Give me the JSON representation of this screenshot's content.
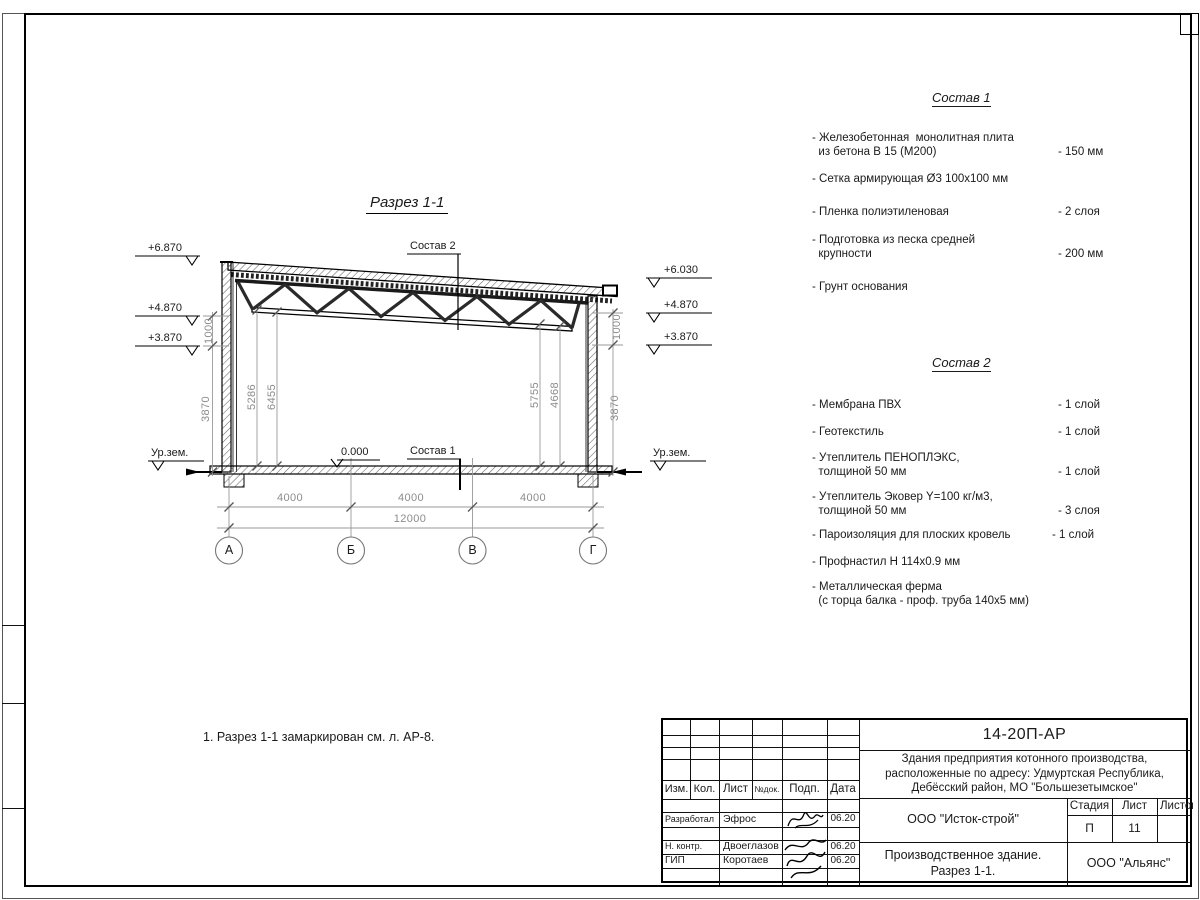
{
  "section": {
    "title": "Разрез 1-1",
    "callout_top": "Состав 2",
    "callout_floor": "Состав 1",
    "level_zero": "0.000",
    "ground_left": "Ур.зем.",
    "ground_right": "Ур.зем.",
    "elev_left": [
      "+6.870",
      "+4.870",
      "+3.870"
    ],
    "elev_right": [
      "+6.030",
      "+4.870",
      "+3.870"
    ],
    "dims": {
      "left_outer": [
        "1000",
        "3870"
      ],
      "left_inner": [
        "5286",
        "6455"
      ],
      "right_inner": [
        "5755",
        "4668"
      ],
      "right_outer": [
        "1000",
        "3870"
      ],
      "spans": [
        "4000",
        "4000",
        "4000"
      ],
      "total": "12000"
    },
    "axes": [
      "А",
      "Б",
      "В",
      "Г"
    ]
  },
  "note": "1. Разрез 1-1 замаркирован см. л. АР-8.",
  "sostav1": {
    "title": "Состав 1",
    "items": [
      {
        "name": "- Железобетонная  монолитная плита\n  из бетона В 15 (М200)",
        "value": "- 150 мм"
      },
      {
        "name": "- Сетка армирующая Ø3 100x100 мм",
        "value": ""
      },
      {
        "name": "- Пленка полиэтиленовая",
        "value": "-  2 слоя"
      },
      {
        "name": "- Подготовка из песка средней\n  крупности",
        "value": "- 200 мм"
      },
      {
        "name": "- Грунт основания",
        "value": ""
      }
    ]
  },
  "sostav2": {
    "title": "Состав 2",
    "items": [
      {
        "name": "- Мембрана ПВХ",
        "value": "- 1 слой"
      },
      {
        "name": "- Геотекстиль",
        "value": "- 1 слой"
      },
      {
        "name": "- Утеплитель ПЕНОПЛЭКС,\n  толщиной 50 мм",
        "value": "- 1 слой"
      },
      {
        "name": "- Утеплитель Эковер Y=100 кг/м3,\n  толщиной 50 мм",
        "value": "- 3 слоя"
      },
      {
        "name": "- Пароизоляция для плоских кровель",
        "value": "- 1 слой"
      },
      {
        "name": "- Профнастил Н 114х0.9 мм",
        "value": ""
      },
      {
        "name": "- Металлическая ферма\n  (с торца балка - проф. труба 140х5 мм)",
        "value": ""
      }
    ]
  },
  "titleblock": {
    "doc_number": "14-20П-АР",
    "project": "Здания предприятия котонного производства,\nрасположенные по адресу: Удмуртская Республика,\nДебёсский район, МО \"Большезетымское\"",
    "header_cols": [
      "Изм.",
      "Кол.",
      "Лист",
      "№док.",
      "Подп.",
      "Дата"
    ],
    "rows": [
      {
        "role": "Разработал",
        "name": "Эфрос",
        "date": "06.20"
      },
      {
        "role": "Н. контр.",
        "name": "Двоеглазов",
        "date": "06.20"
      },
      {
        "role": "ГИП",
        "name": "Коротаев",
        "date": "06.20"
      }
    ],
    "company": "ООО \"Исток-строй\"",
    "stage_label": "Стадия",
    "sheet_label": "Лист",
    "sheets_label": "Листов",
    "stage": "П",
    "sheet_num": "11",
    "sheets_num": "",
    "object": "Производственное здание.\nРазрез 1-1.",
    "contractor": "ООО \"Альянс\""
  }
}
